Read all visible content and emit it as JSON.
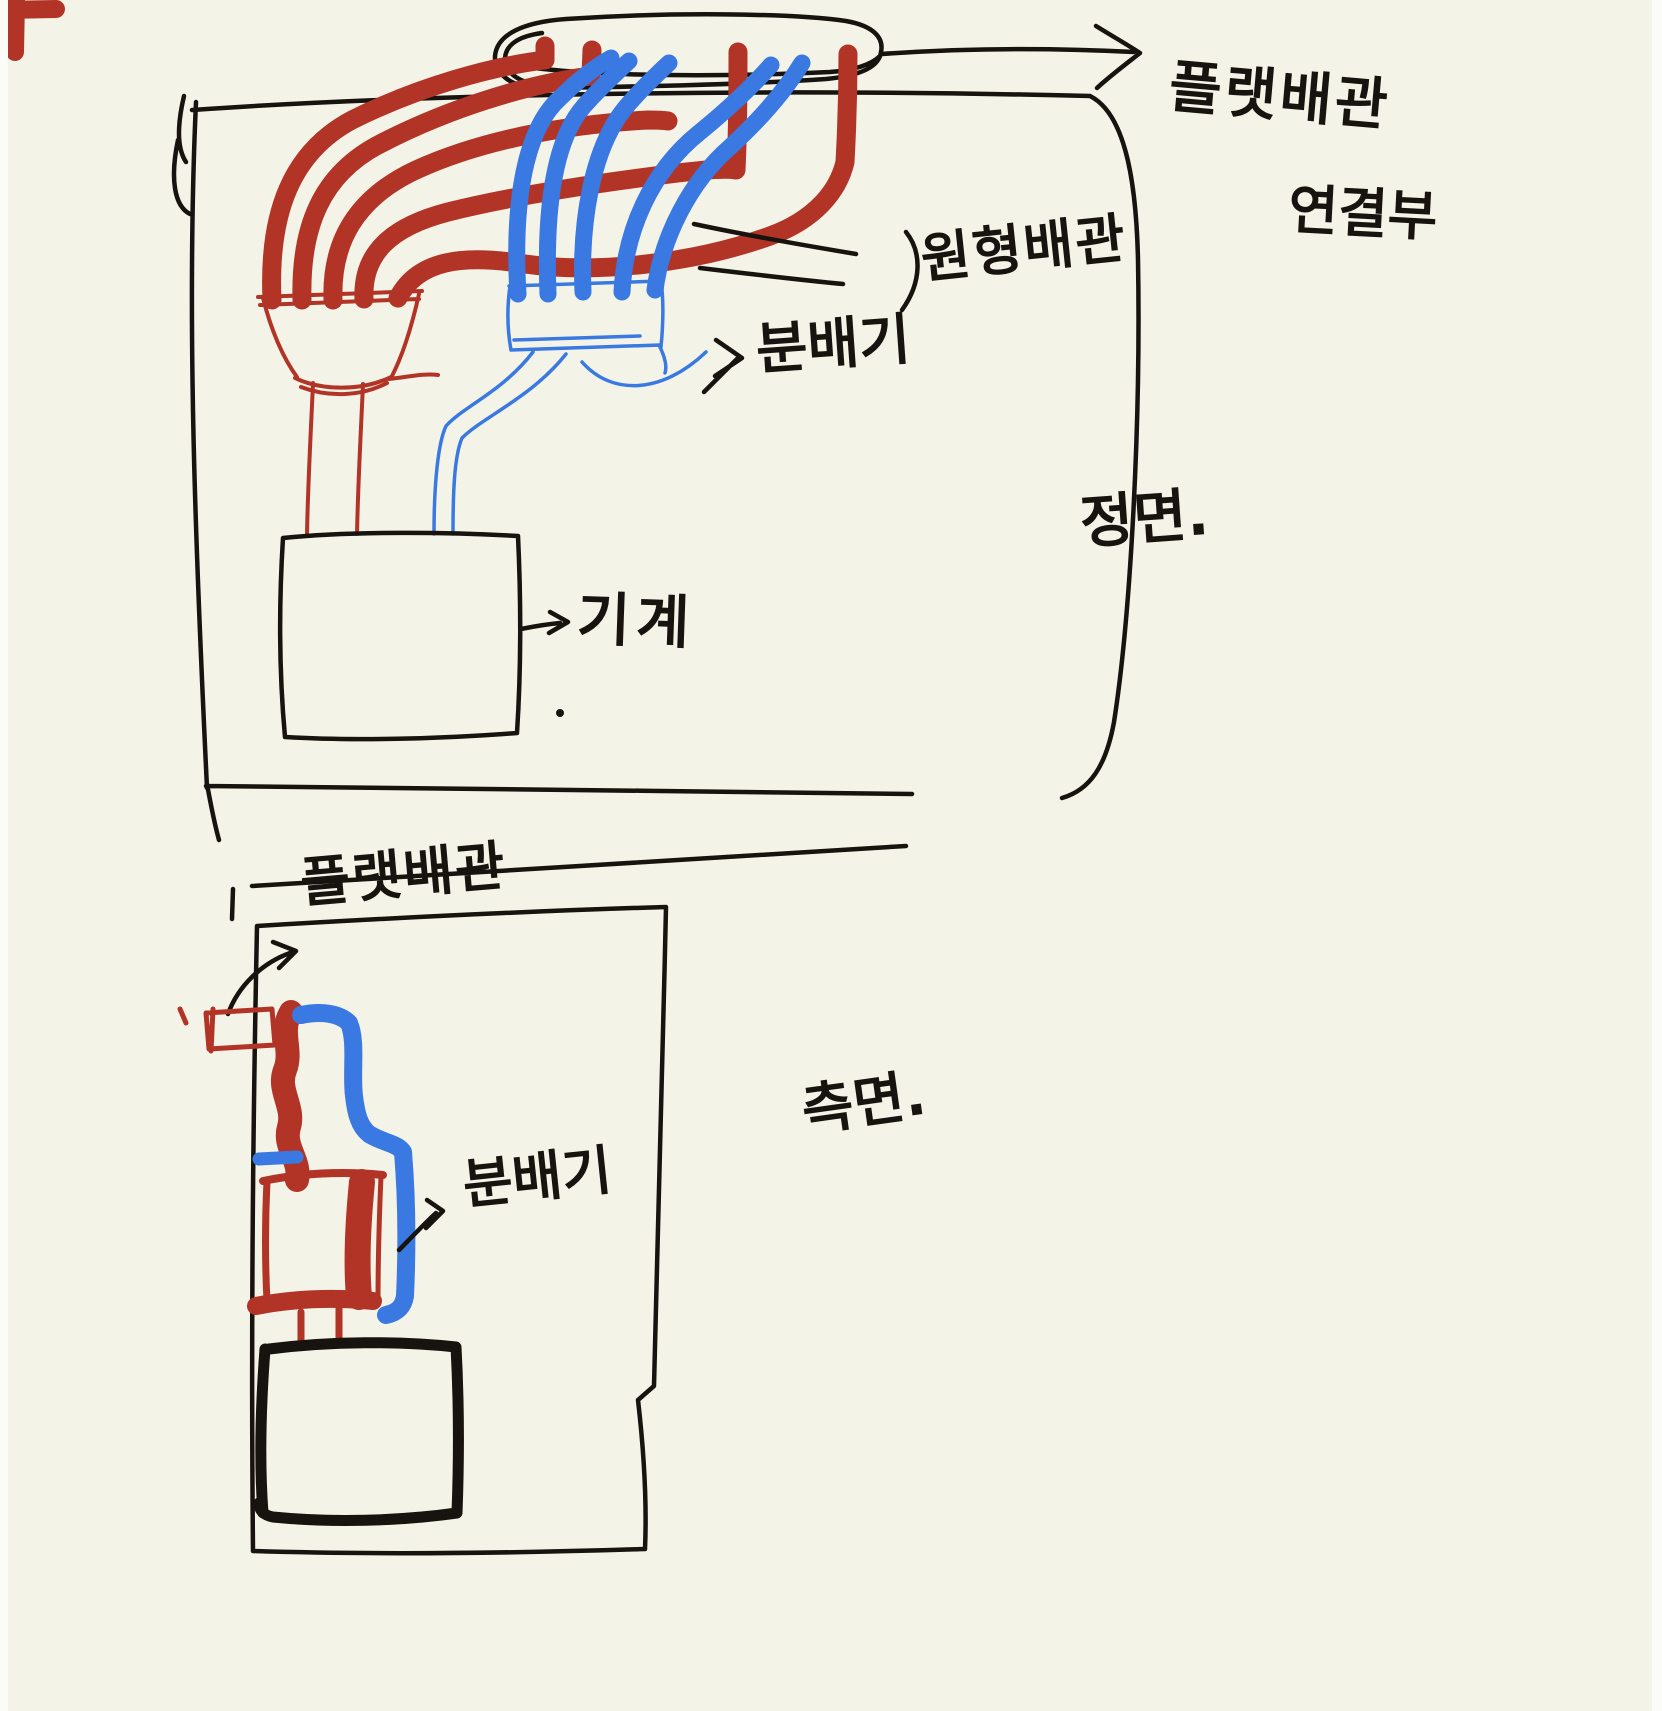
{
  "canvas": {
    "colors": {
      "paper": "#f4f3e7",
      "page": "#fbfbf8",
      "ink": "#17130e",
      "red": "#b23427",
      "blue": "#3a78e2"
    }
  },
  "front_view": {
    "title": "정면.",
    "labels": {
      "flat_pipe_connection_line1": "플랫배관",
      "flat_pipe_connection_line2": "연결부",
      "round_pipe": "원형배관",
      "manifold": "분배기",
      "machine": "기계"
    }
  },
  "side_view": {
    "title": "측면.",
    "labels": {
      "flat_pipe": "플랫배관",
      "manifold": "분배기"
    }
  }
}
